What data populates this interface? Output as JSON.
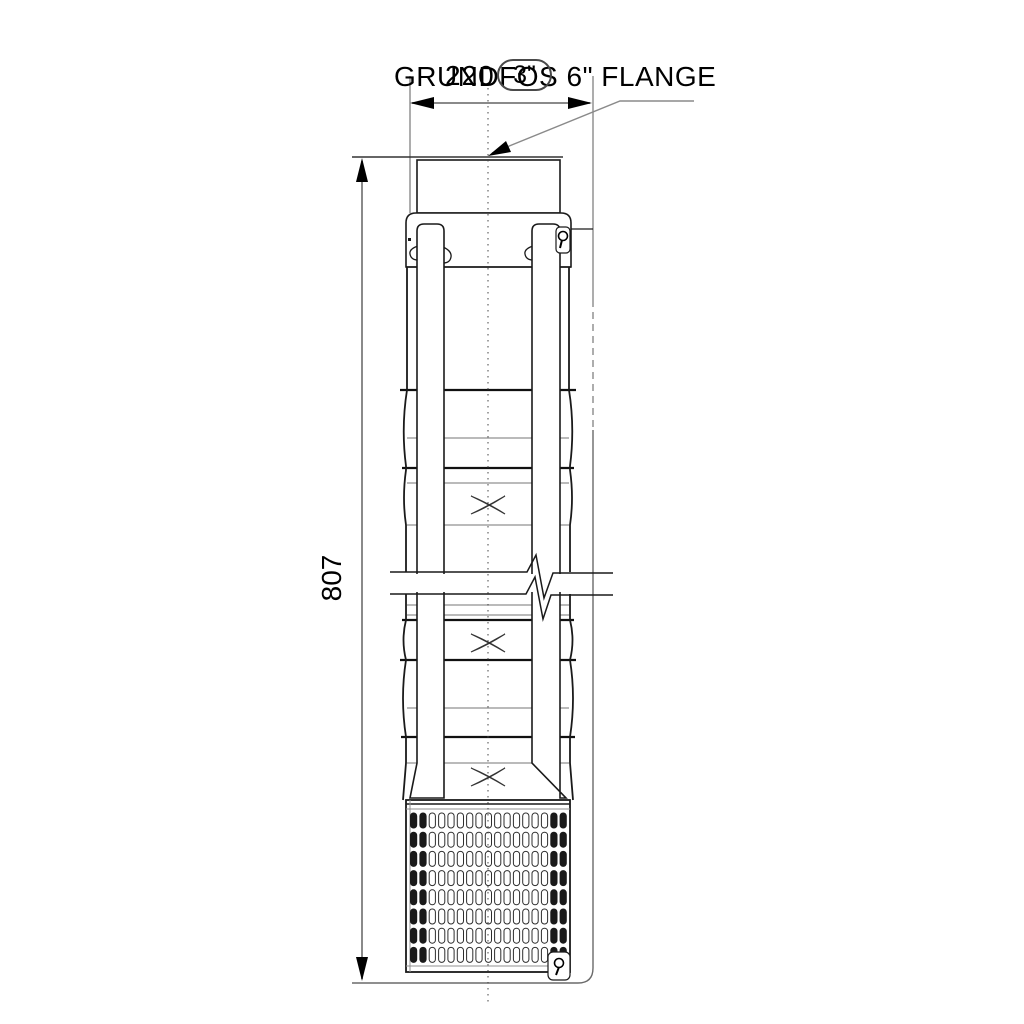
{
  "title": "GRUNDFOS 6\" FLANGE",
  "dimensions": {
    "width": "220",
    "height": "807",
    "connection": "3\""
  },
  "colors": {
    "object_line": "#1a1a1a",
    "dimension_line": "#8a8a8a",
    "joint_line": "#909090",
    "background": "#ffffff",
    "text": "#000000"
  }
}
